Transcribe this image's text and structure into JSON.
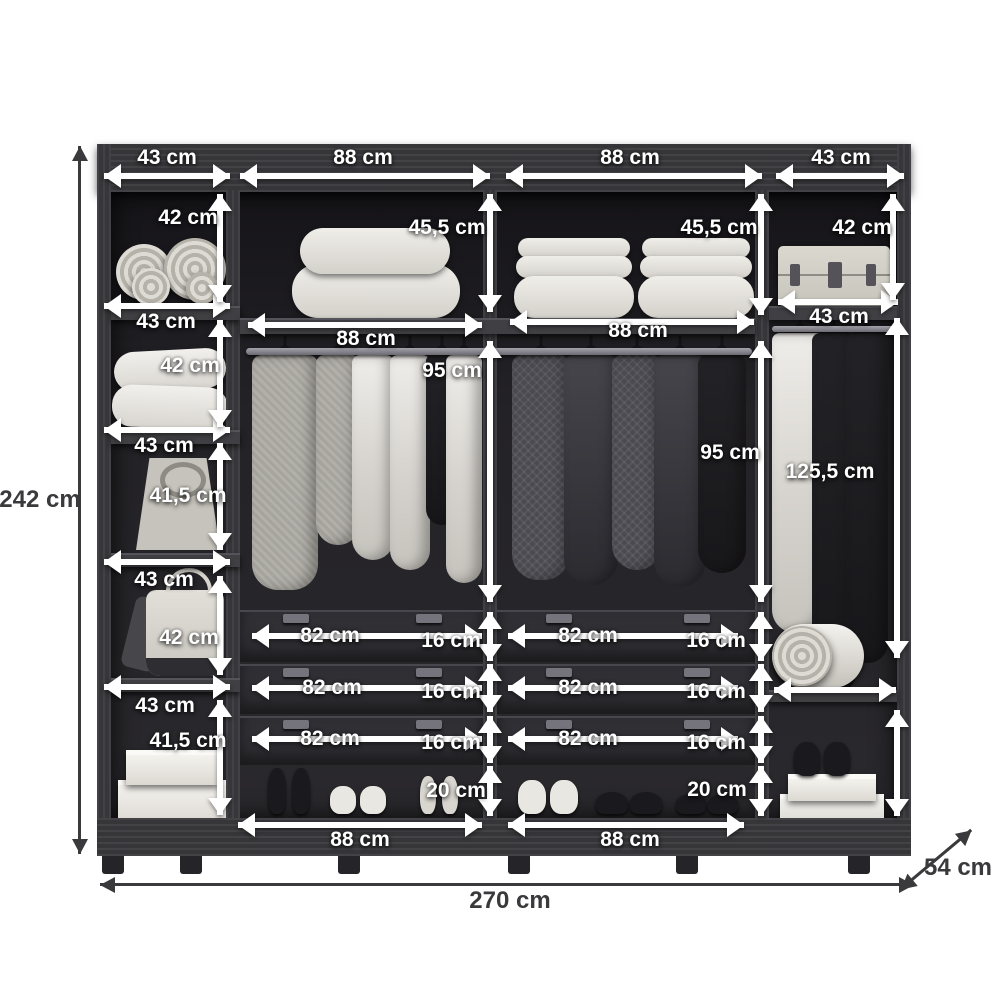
{
  "diagram_title": "Wardrobe interior dimensions",
  "unit": "cm",
  "overall": {
    "height": "242 cm",
    "width": "270 cm",
    "depth": "54 cm"
  },
  "left_column": {
    "top_width": "43 cm",
    "shelf_widths": [
      "43 cm",
      "43 cm",
      "43 cm",
      "43 cm"
    ],
    "shelf_heights": [
      "42 cm",
      "42 cm",
      "41,5 cm",
      "42 cm",
      "41,5 cm"
    ]
  },
  "center_left": {
    "top_width": "88 cm",
    "top_shelf_height": "45,5 cm",
    "shelf_width": "88 cm",
    "hanging_height": "95 cm",
    "drawer_widths": [
      "82 cm",
      "82 cm",
      "82 cm"
    ],
    "drawer_heights": [
      "16 cm",
      "16 cm",
      "16 cm"
    ],
    "shoe_space_height": "20 cm",
    "bottom_width": "88 cm"
  },
  "center_right": {
    "top_width": "88 cm",
    "top_shelf_height": "45,5 cm",
    "shelf_width": "88 cm",
    "hanging_height": "95 cm",
    "drawer_widths": [
      "82 cm",
      "82 cm",
      "82 cm"
    ],
    "drawer_heights": [
      "16 cm",
      "16 cm",
      "16 cm"
    ],
    "shoe_space_height": "20 cm",
    "bottom_width": "88 cm"
  },
  "right_column": {
    "top_width": "43 cm",
    "top_shelf_height": "42 cm",
    "shelf_width": "43 cm",
    "hanging_height": "125,5 cm"
  }
}
